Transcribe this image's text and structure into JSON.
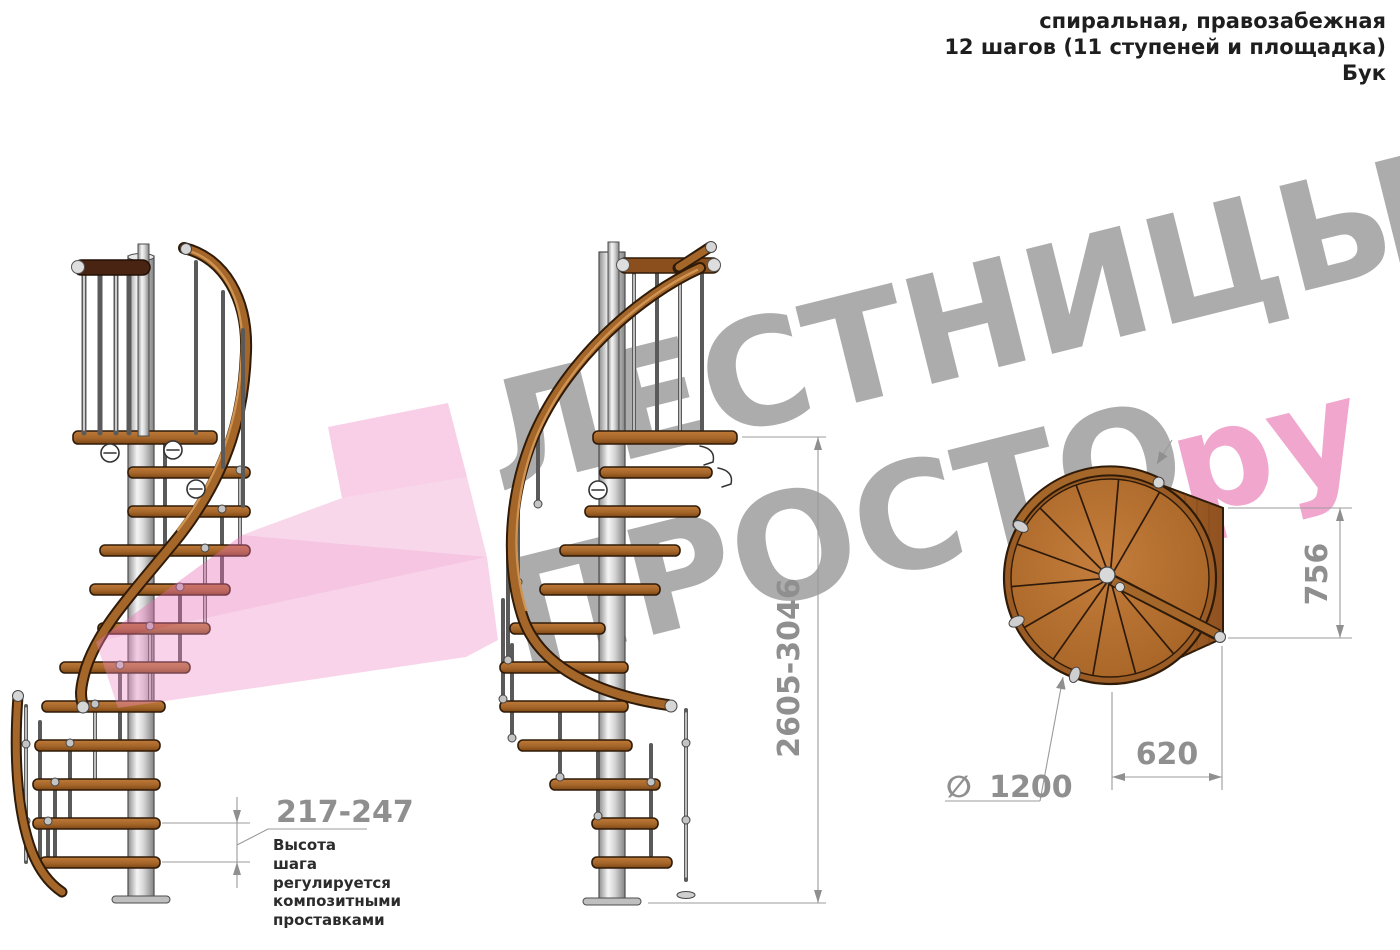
{
  "header": {
    "line1": "спиральная, правозабежная",
    "line2": "12 шагов (11 ступеней и площадка)",
    "line3": "Бук"
  },
  "watermark": {
    "brand_top": "ЛЕСТНИЦЫ",
    "brand_bottom": "ПРОСТО",
    "brand_suffix": "ру",
    "gray_color": "#a1a1a1",
    "pink_color": "#f0a2cb"
  },
  "dimensions": {
    "step_height": "217-247",
    "total_height": "2605-3046",
    "plan_height": "756",
    "plan_width": "620",
    "diameter_symbol": "∅",
    "diameter_value": "1200"
  },
  "notes": {
    "step_note": "Высота шага регулируется композитными проставками"
  },
  "colors": {
    "wood": "#a5662a",
    "wood_dark": "#2f1b08",
    "metal": "#d9d9d9",
    "dim_gray": "#8f8f8f",
    "pink_arrow": "#ee8cc6"
  }
}
